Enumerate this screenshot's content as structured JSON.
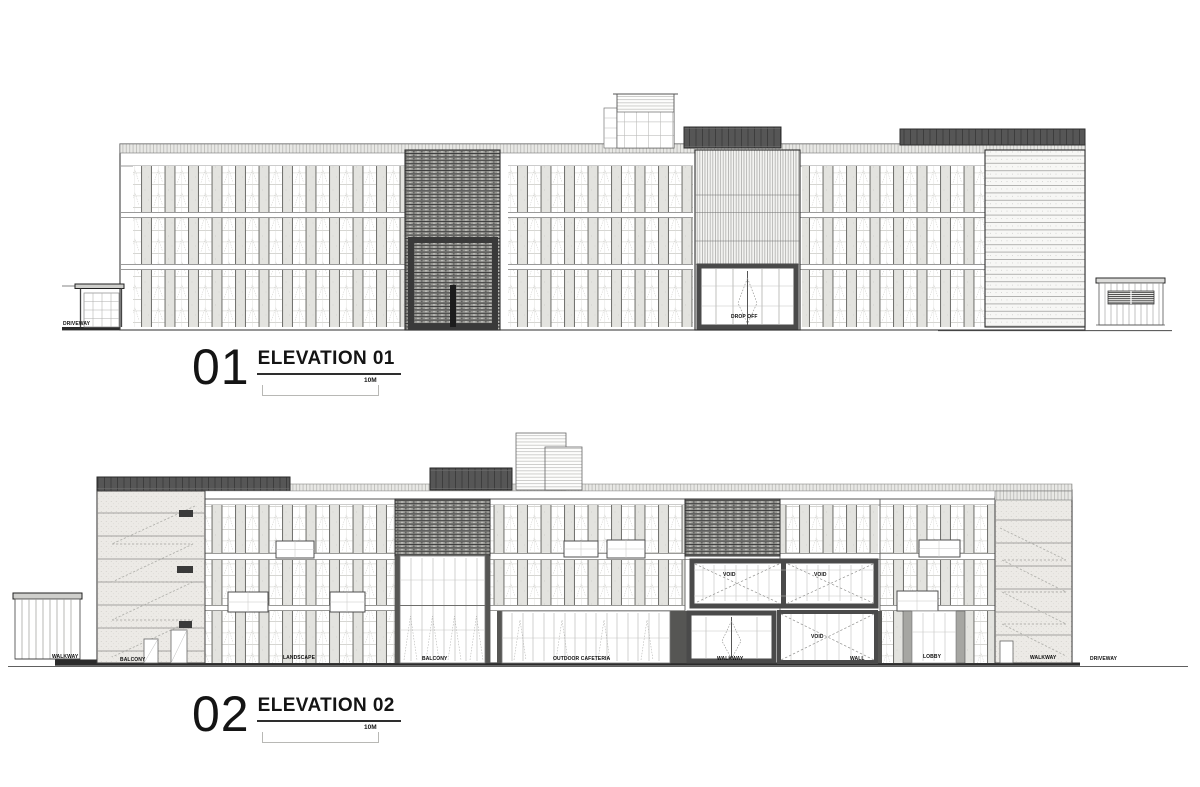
{
  "sheet": {
    "background": "#ffffff",
    "ink": "#2b2b2b",
    "pillar_gray": "#e3e3df",
    "mesh_gray": "#969692",
    "dark_band": "#565656"
  },
  "drawings": [
    {
      "id": "elevation-01",
      "number": "01",
      "title": "ELEVATION 01",
      "scale_label": "10M",
      "annotations": [
        {
          "text": "DRIVEWAY"
        },
        {
          "text": "DROP OFF"
        }
      ]
    },
    {
      "id": "elevation-02",
      "number": "02",
      "title": "ELEVATION 02",
      "scale_label": "10M",
      "annotations": [
        {
          "text": "WALKWAY"
        },
        {
          "text": "BALCONY"
        },
        {
          "text": "LANDSCAPE"
        },
        {
          "text": "BALCONY"
        },
        {
          "text": "OUTDOOR CAFETERIA"
        },
        {
          "text": "WALKWAY"
        },
        {
          "text": "WALL"
        },
        {
          "text": "LOBBY"
        },
        {
          "text": "WALKWAY"
        },
        {
          "text": "DRIVEWAY"
        },
        {
          "text": "VOID"
        },
        {
          "text": "VOID"
        },
        {
          "text": "VOID"
        }
      ]
    }
  ]
}
